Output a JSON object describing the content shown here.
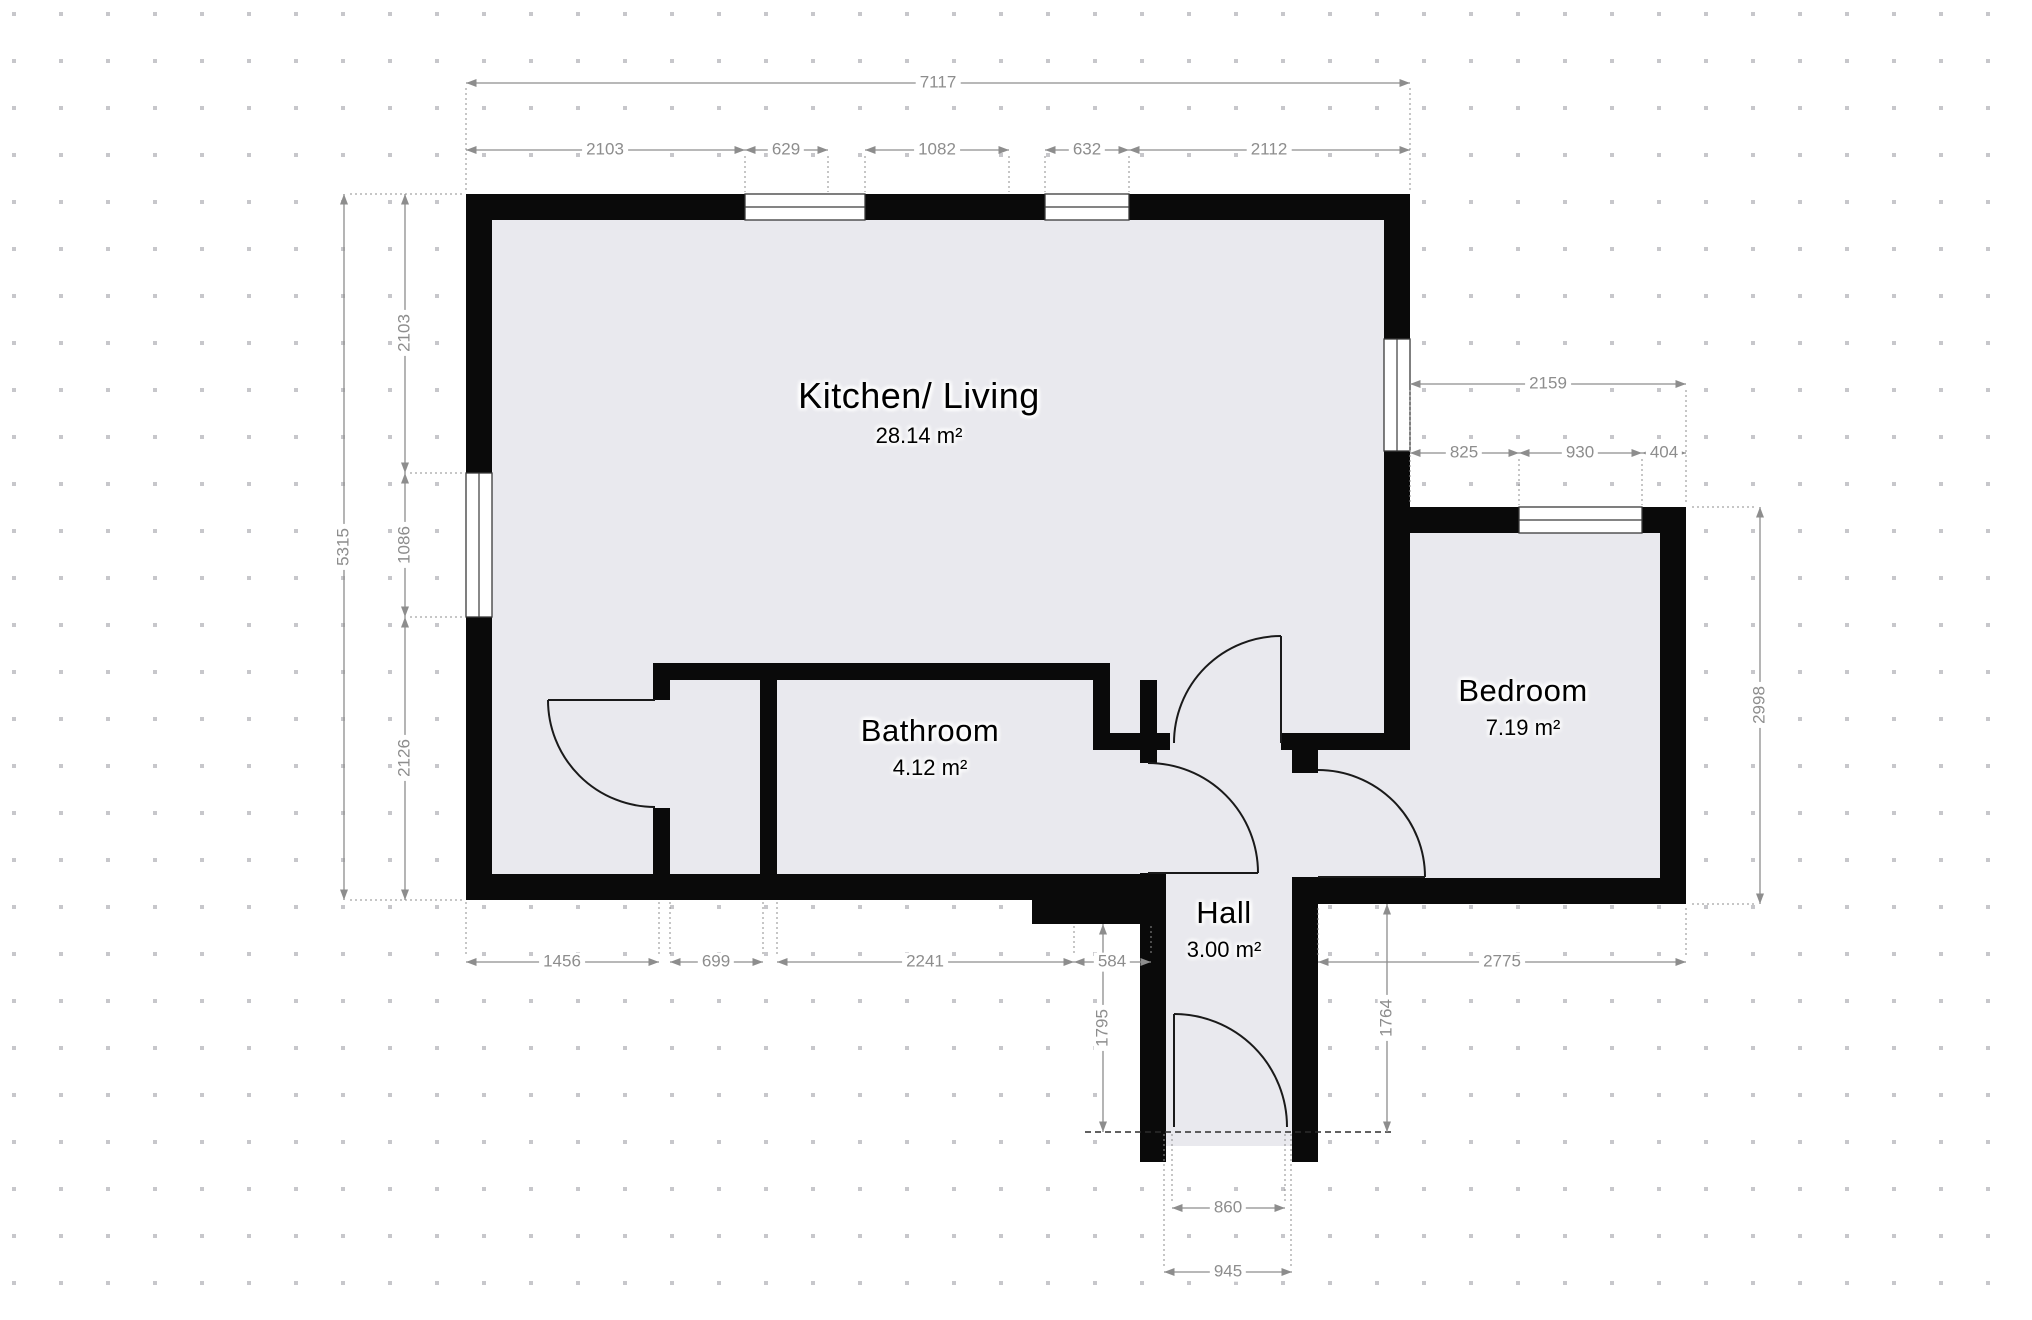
{
  "plan": {
    "rooms": [
      {
        "name": "Kitchen/ Living",
        "area": "28.14 m²",
        "x": 919,
        "y": 412,
        "size": "large"
      },
      {
        "name": "Bathroom",
        "area": "4.12 m²",
        "x": 930,
        "y": 747,
        "size": "small"
      },
      {
        "name": "Bedroom",
        "area": "7.19 m²",
        "x": 1523,
        "y": 707,
        "size": "small"
      },
      {
        "name": "Hall",
        "area": "3.00 m²",
        "x": 1224,
        "y": 929,
        "size": "small"
      }
    ],
    "dimensions": [
      {
        "label": "7117",
        "x": 938,
        "y": 83,
        "rot": false
      },
      {
        "label": "2103",
        "x": 605,
        "y": 150,
        "rot": false
      },
      {
        "label": "629",
        "x": 786,
        "y": 150,
        "rot": false
      },
      {
        "label": "1082",
        "x": 937,
        "y": 150,
        "rot": false
      },
      {
        "label": "632",
        "x": 1087,
        "y": 150,
        "rot": false
      },
      {
        "label": "2112",
        "x": 1269,
        "y": 150,
        "rot": false
      },
      {
        "label": "5315",
        "x": 344,
        "y": 547,
        "rot": true
      },
      {
        "label": "2103",
        "x": 405,
        "y": 333,
        "rot": true
      },
      {
        "label": "1086",
        "x": 405,
        "y": 545,
        "rot": true
      },
      {
        "label": "2126",
        "x": 405,
        "y": 758,
        "rot": true
      },
      {
        "label": "2159",
        "x": 1548,
        "y": 384,
        "rot": false
      },
      {
        "label": "825",
        "x": 1464,
        "y": 453,
        "rot": false
      },
      {
        "label": "930",
        "x": 1580,
        "y": 453,
        "rot": false
      },
      {
        "label": "404",
        "x": 1664,
        "y": 453,
        "rot": false
      },
      {
        "label": "2998",
        "x": 1760,
        "y": 705,
        "rot": true
      },
      {
        "label": "1456",
        "x": 562,
        "y": 962,
        "rot": false
      },
      {
        "label": "699",
        "x": 716,
        "y": 962,
        "rot": false
      },
      {
        "label": "2241",
        "x": 925,
        "y": 962,
        "rot": false
      },
      {
        "label": "584",
        "x": 1112,
        "y": 962,
        "rot": false
      },
      {
        "label": "2775",
        "x": 1502,
        "y": 962,
        "rot": false
      },
      {
        "label": "1795",
        "x": 1103,
        "y": 1028,
        "rot": true
      },
      {
        "label": "1764",
        "x": 1387,
        "y": 1018,
        "rot": true
      },
      {
        "label": "860",
        "x": 1228,
        "y": 1208,
        "rot": false
      },
      {
        "label": "945",
        "x": 1228,
        "y": 1272,
        "rot": false
      }
    ],
    "colors": {
      "wall": "#0a0a0a",
      "floor": "#e9e9ee",
      "dim": "#8d8d8d",
      "grid": "#c7c7cb",
      "door": "#1a1a1a"
    }
  }
}
